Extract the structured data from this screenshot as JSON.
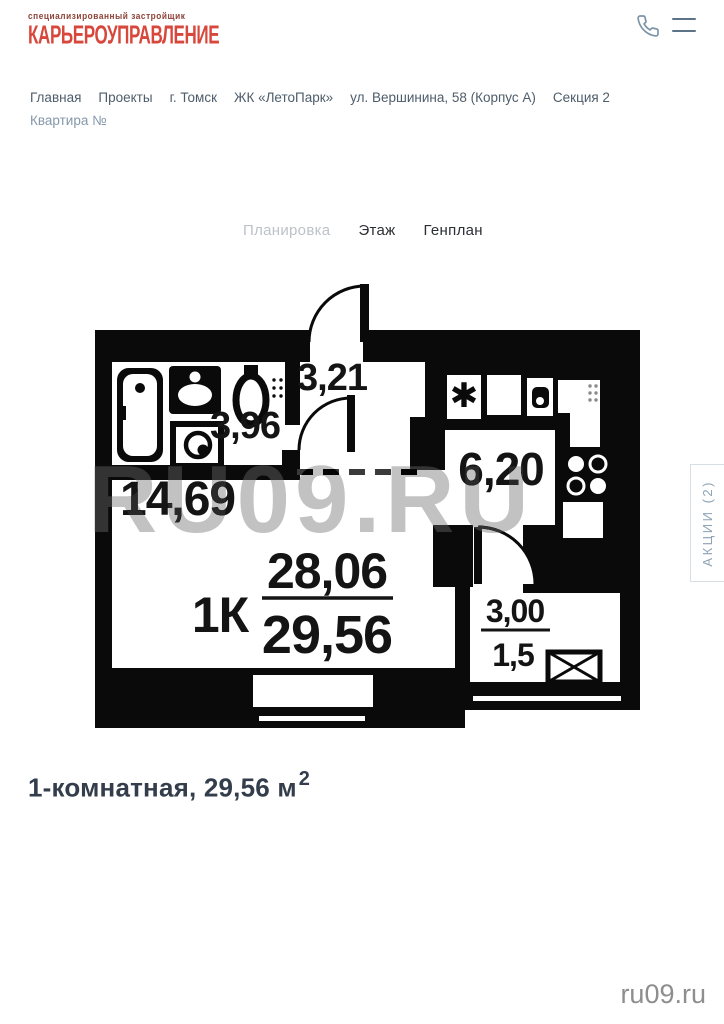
{
  "brand": {
    "tagline": "специализированный застройщик",
    "name": "КАРЬЕРОУПРАВЛЕНИЕ"
  },
  "topbar": {
    "phone_icon": "phone-outline-icon",
    "menu_icon": "hamburger-menu-icon"
  },
  "breadcrumb": {
    "items": [
      "Главная",
      "Проекты",
      "г. Томск",
      "ЖК «ЛетоПарк»",
      "ул. Вершинина, 58 (Корпус А)",
      "Секция 2",
      "Квартира №"
    ]
  },
  "tabs": {
    "planirovka": "Планировка",
    "etazh": "Этаж",
    "genplan": "Генплан"
  },
  "plan": {
    "hall_area": "3,21",
    "bathroom_area": "3,96",
    "kitchen_area": "6,20",
    "living_area": "14,69",
    "type_label": "1К",
    "area_upper": "28,06",
    "area_lower": "29,56",
    "balcony_area": "3,00",
    "balcony_reduced": "1,5"
  },
  "promo": {
    "label": "АКЦИИ (2)"
  },
  "title": {
    "text": "1-комнатная, 29,56 м",
    "sup": "2"
  },
  "watermark": {
    "plan": "RU09.RU",
    "site": "ru09.ru"
  },
  "colors": {
    "brand_red": "#d8473c",
    "accent_slate": "#8da3b6",
    "text_dark": "#333d4b",
    "plan_ink": "#0a0a0a"
  }
}
